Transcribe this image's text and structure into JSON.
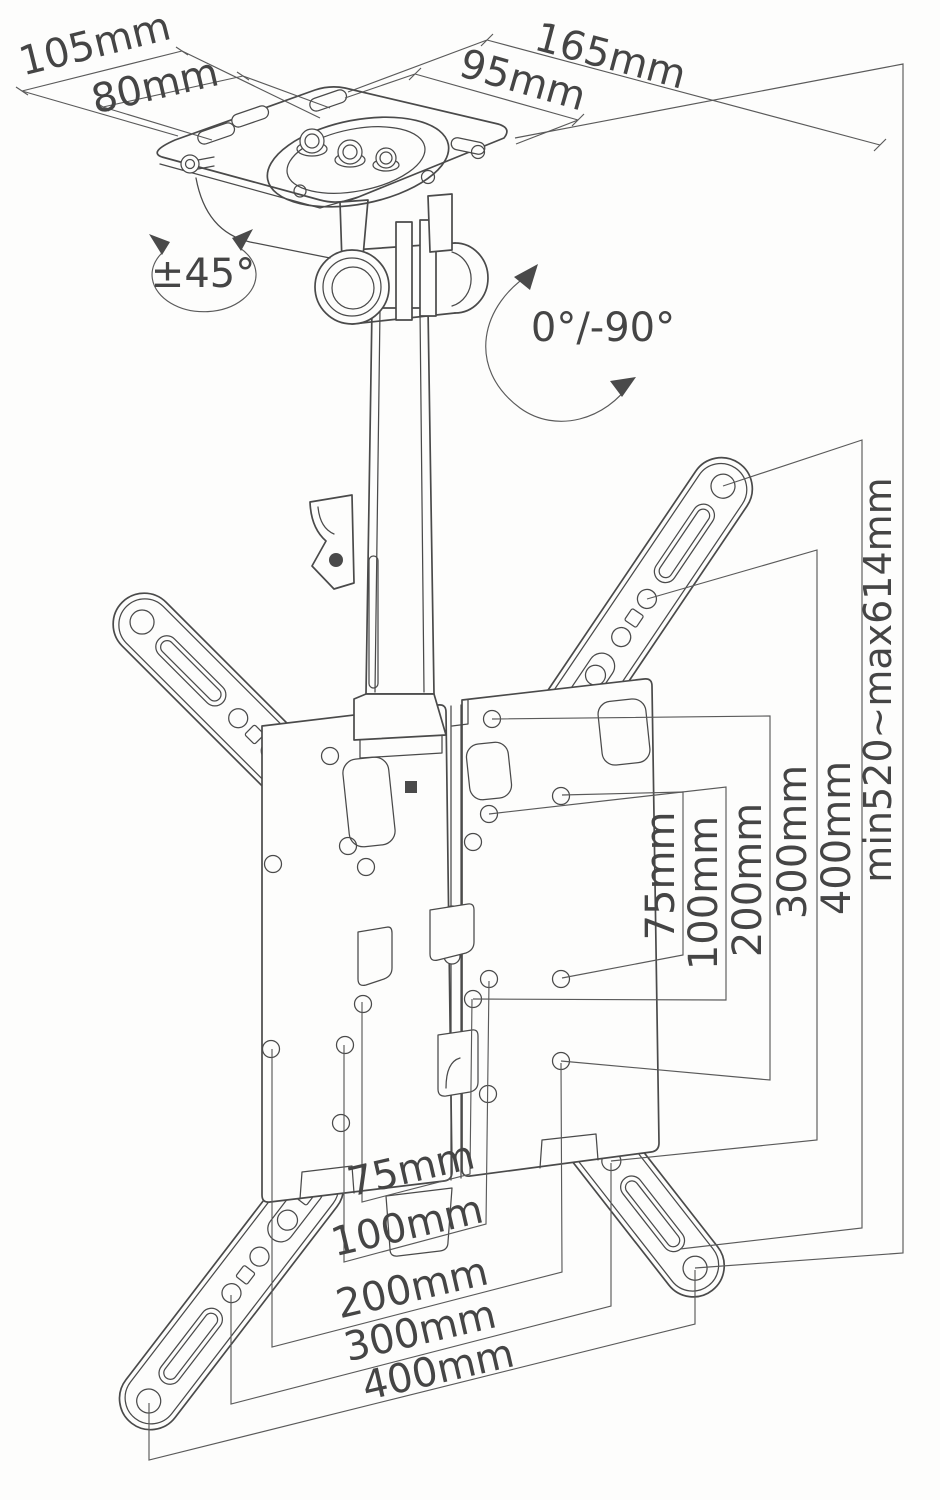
{
  "diagram": {
    "subject": "ceiling-tv-mount-dimension-drawing",
    "background_color": "#fdfdfc",
    "line_color": "#4a4a4a",
    "text_color": "#454545",
    "labels": {
      "plate_depth_overall": "105mm",
      "plate_depth_holes": "80mm",
      "plate_width_overall": "165mm",
      "plate_width_holes": "95mm",
      "swivel_range": "±45°",
      "tilt_range": "0°/-90°",
      "height_range": "min520~max614mm",
      "vesa_v_75": "75mm",
      "vesa_v_100": "100mm",
      "vesa_v_200": "200mm",
      "vesa_v_300": "300mm",
      "vesa_v_400": "400mm",
      "vesa_h_75": "75mm",
      "vesa_h_100": "100mm",
      "vesa_h_200": "200mm",
      "vesa_h_300": "300mm",
      "vesa_h_400": "400mm"
    }
  }
}
